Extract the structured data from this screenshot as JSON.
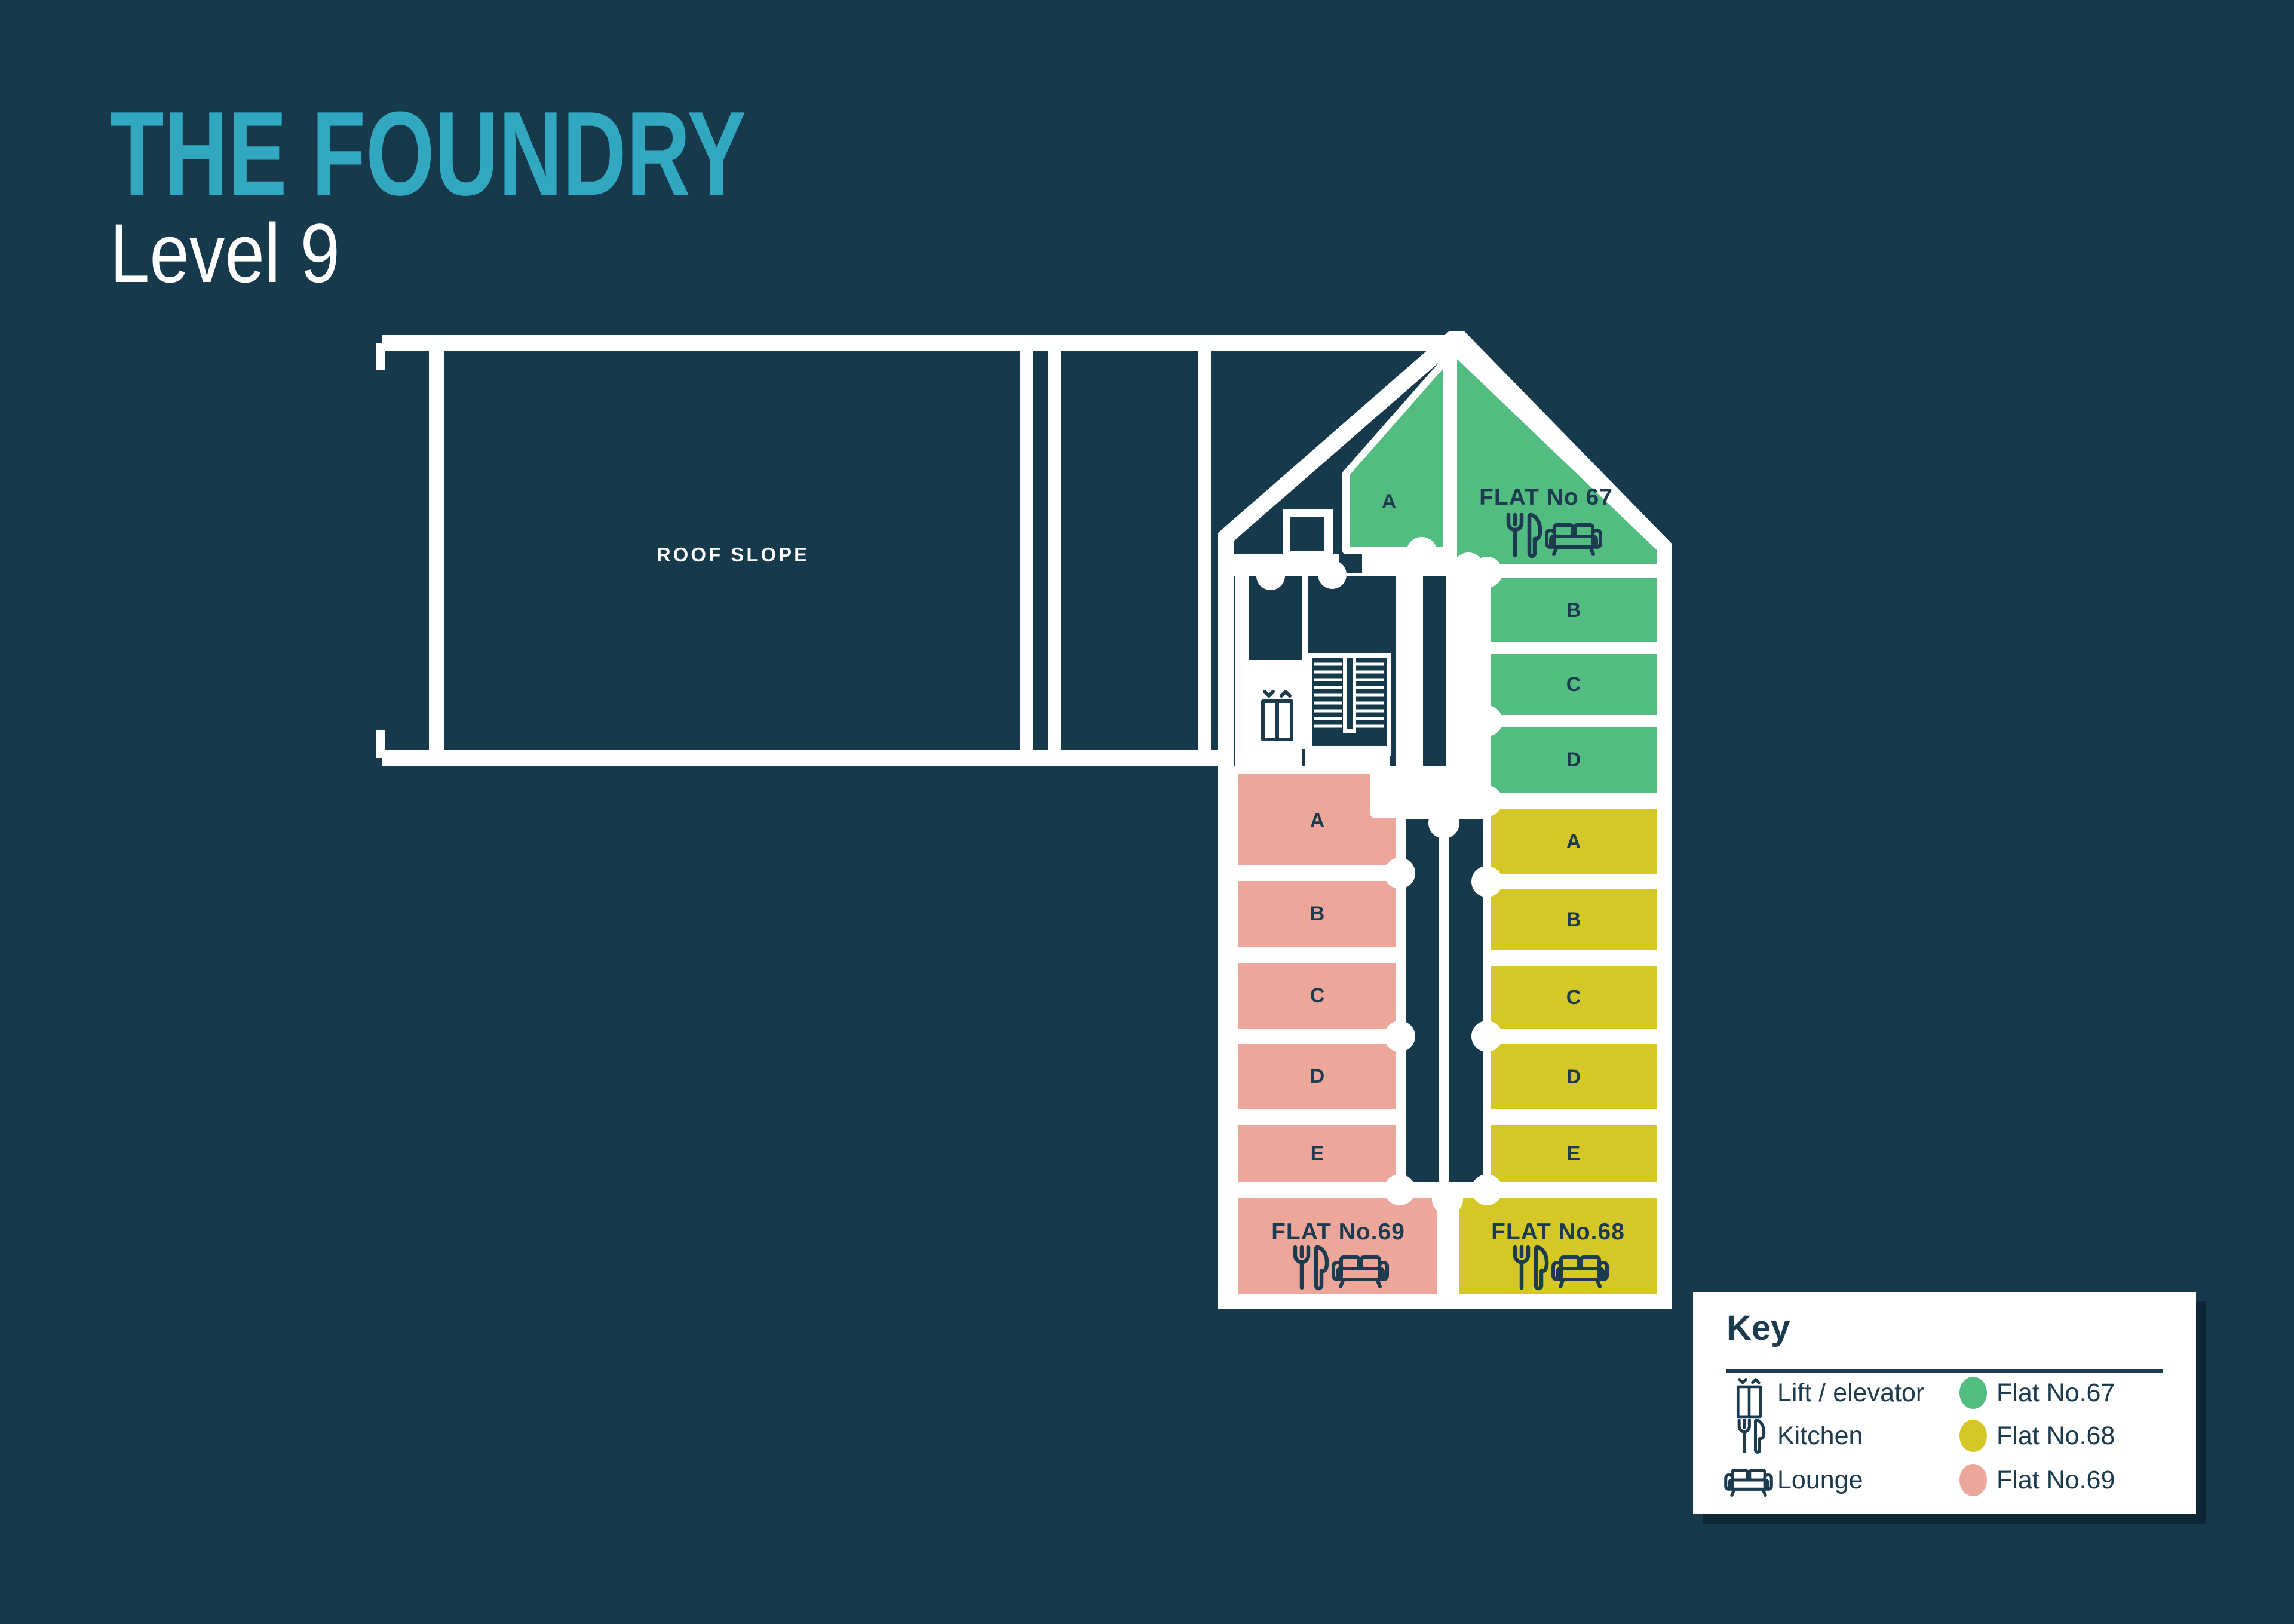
{
  "page": {
    "title": "THE FOUNDRY",
    "subtitle": "Level 9"
  },
  "colors": {
    "background": "#17394C",
    "ink": "#1D3B4F",
    "wall": "#FFFFFF",
    "title": "#31A8C0",
    "flat67": "#53BD81",
    "flat68": "#D5C727",
    "flat69": "#ECA79A"
  },
  "plan": {
    "roof_label": "ROOF SLOPE",
    "flat67": {
      "name": "FLAT No 67",
      "rooms": [
        "A",
        "B",
        "C",
        "D"
      ]
    },
    "flat68": {
      "name": "FLAT No.68",
      "rooms": [
        "A",
        "B",
        "C",
        "D",
        "E"
      ]
    },
    "flat69": {
      "name": "FLAT No.69",
      "rooms": [
        "A",
        "B",
        "C",
        "D",
        "E"
      ]
    }
  },
  "key": {
    "title": "Key",
    "icon_items": [
      {
        "icon": "lift-icon",
        "label": "Lift / elevator"
      },
      {
        "icon": "kitchen-icon",
        "label": "Kitchen"
      },
      {
        "icon": "lounge-icon",
        "label": "Lounge"
      }
    ],
    "flat_items": [
      {
        "label": "Flat No.67",
        "color": "#53BD81"
      },
      {
        "label": "Flat No.68",
        "color": "#D5C727"
      },
      {
        "label": "Flat No.69",
        "color": "#ECA79A"
      }
    ]
  }
}
